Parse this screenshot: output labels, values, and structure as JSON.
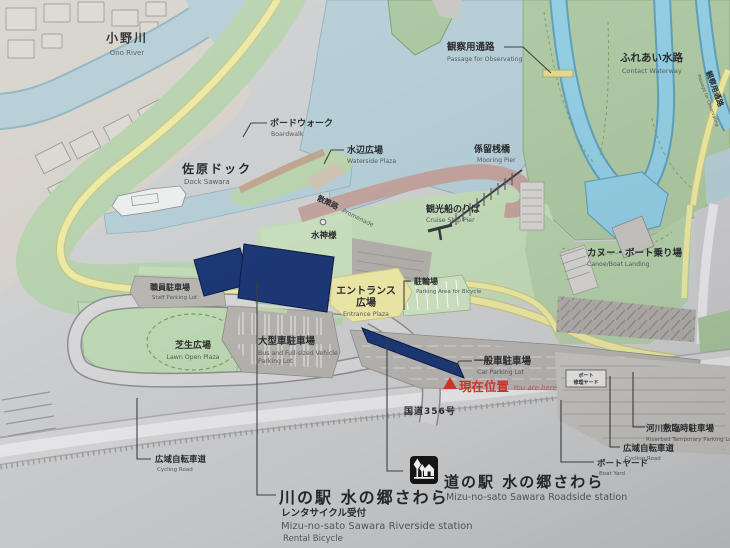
{
  "board": {
    "labels": {
      "ono_river": {
        "jp": "小野川",
        "en": "Ono River"
      },
      "passage_observing": {
        "jp": "観察用通路",
        "en": "Passage for Observating"
      },
      "passage_observing_side": {
        "jp": "観察用通路",
        "en": "Passage for Observating"
      },
      "contact_waterway": {
        "jp": "ふれあい水路",
        "en": "Contact Waterway"
      },
      "boardwalk": {
        "jp": "ボードウォーク",
        "en": "Boardwalk"
      },
      "waterside_plaza": {
        "jp": "水辺広場",
        "en": "Waterside Plaza"
      },
      "dock_sawara": {
        "jp": "佐原ドック",
        "en": "Dock Sawara"
      },
      "mooring_pier": {
        "jp": "係留桟橋",
        "en": "Mooring Pier"
      },
      "cruise_ship_pier": {
        "jp": "観光船のりば",
        "en": "Cruise Ship Pier"
      },
      "promenade": {
        "jp": "散策路",
        "en": "Promenade"
      },
      "water_god": {
        "jp": "水神様"
      },
      "entrance_plaza": {
        "jp_line1": "エントランス",
        "jp_line2": "広場",
        "en": "Entrance Plaza"
      },
      "bicycle_parking": {
        "jp": "駐輪場",
        "en": "Parking Area for Bicycle"
      },
      "canoe_boat_landing": {
        "jp": "カヌー・ボート乗り場",
        "en": "Canoe/Boat Landing"
      },
      "staff_parking": {
        "jp": "職員駐車場",
        "en": "Staff Parking Lot"
      },
      "lawn_open_plaza": {
        "jp": "芝生広場",
        "en": "Lawn Open Plaza"
      },
      "bus_parking": {
        "jp": "大型車駐車場",
        "en_line1": "Bus and Full-sized Vehicle",
        "en_line2": "Parking Lot"
      },
      "car_parking": {
        "jp": "一般車駐車場",
        "en": "Car Parking Lot"
      },
      "current_location": {
        "jp": "現在位置",
        "en": "You are here"
      },
      "route_356": {
        "jp": "国道356号"
      },
      "boat_repair_yard": {
        "jp_line1": "ボート",
        "jp_line2": "修理ヤード"
      },
      "riverbed_parking": {
        "jp": "河川敷臨時駐車場",
        "en": "Riverbed Temporary Parking Lot"
      },
      "cycling_road_right": {
        "jp": "広域自転車道",
        "en": "Cycling Road"
      },
      "boat_yard": {
        "jp": "ボートヤード",
        "en": "Boat Yard"
      },
      "cycling_road_left": {
        "jp": "広域自転車道",
        "en": "Cycling Road"
      }
    },
    "legend": {
      "riverside_station": {
        "jp": "川の駅 水の郷さわら",
        "jp_sub": "レンタサイクル受付",
        "en": "Mizu-no-sato Sawara Riverside station",
        "en_sub": "Rental Bicycle"
      },
      "roadside_station": {
        "jp": "道の駅 水の郷さわら",
        "en": "Mizu-no-sato Sawara Roadside station"
      }
    },
    "colors": {
      "paper": "#cdcfd1",
      "water": "#b5cdd6",
      "waterway": "#92cde3",
      "park_green": "#adc8a3",
      "lawn_green": "#bedab4",
      "road_yellow": "#ece9a2",
      "building_navy": "#1c3876",
      "promenade": "#c2a29c",
      "parking_gray": "#b7b4b1",
      "marker_red": "#d7352a"
    }
  }
}
